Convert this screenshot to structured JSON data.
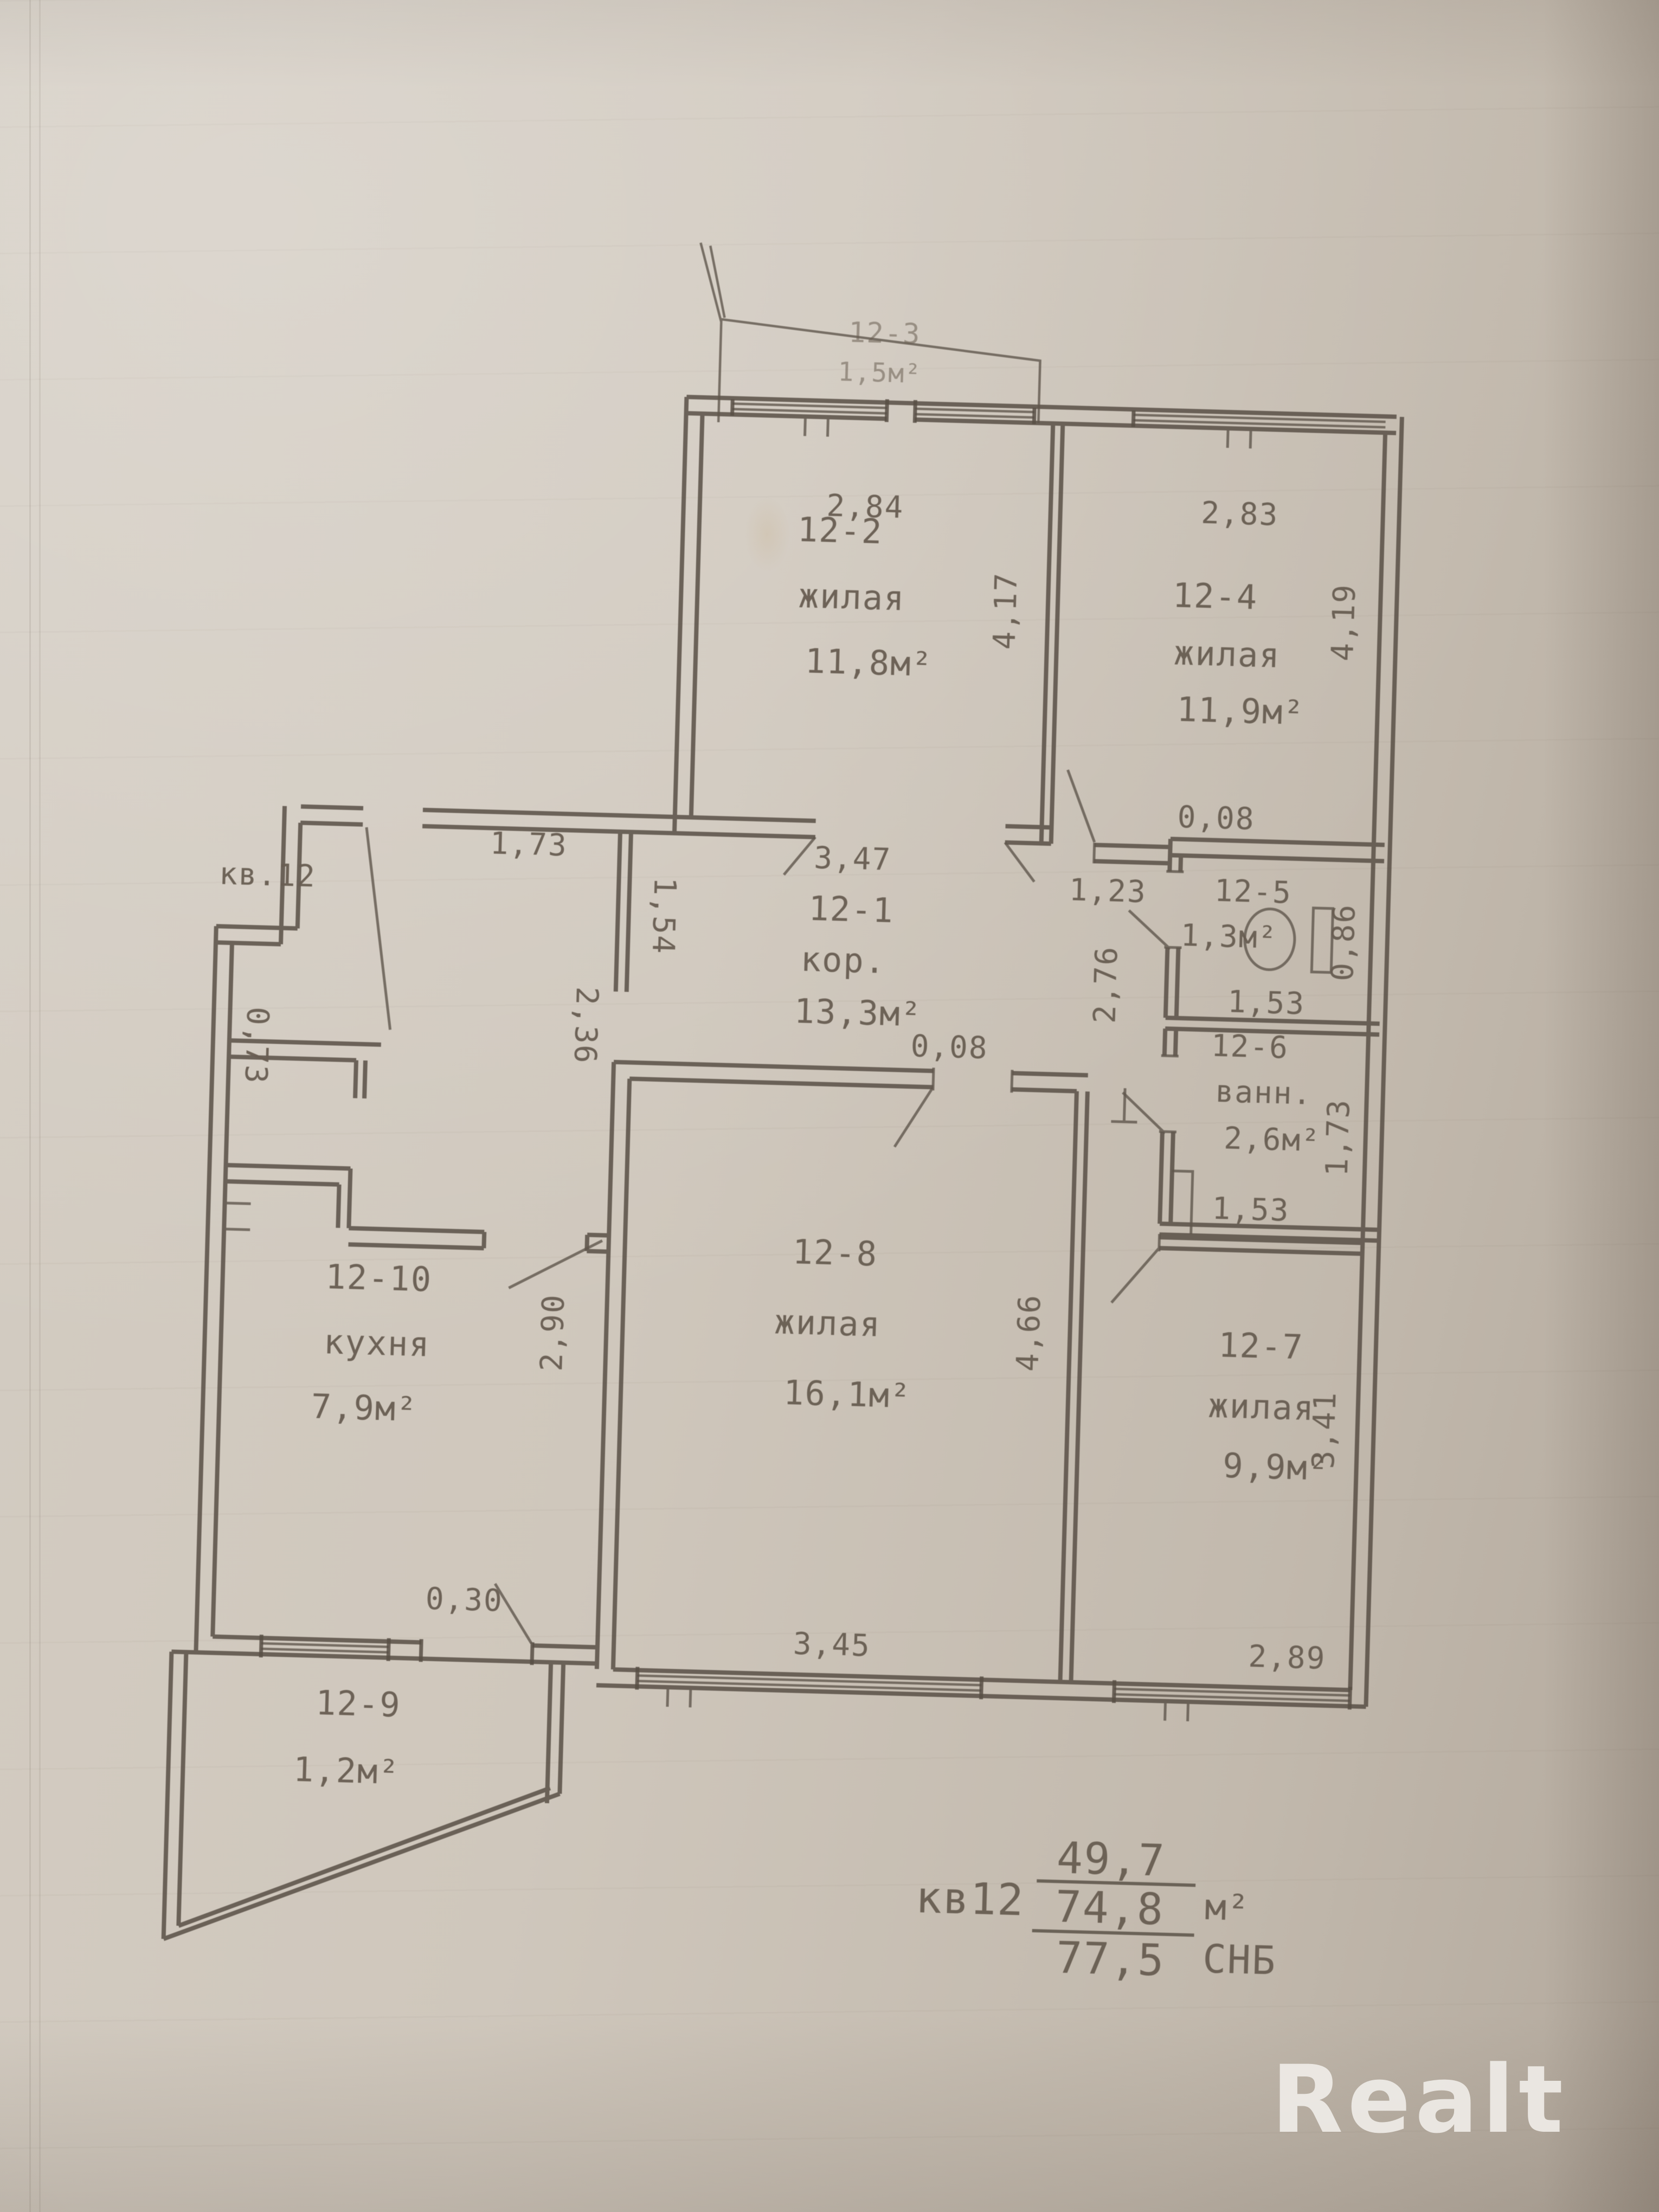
{
  "colors": {
    "paper": "#cdc5b9",
    "ink_lines": "#584f45",
    "ink_text": "#675d51",
    "watermark": "#efece7"
  },
  "apartment_note": "кв.12",
  "rooms": {
    "r12_1": {
      "id": "12-1",
      "name": "кор.",
      "area": "13,3м²"
    },
    "r12_2": {
      "id": "12-2",
      "name": "жилая",
      "area": "11,8м²"
    },
    "r12_3": {
      "id": "12-3",
      "area": "1,5м²"
    },
    "r12_4": {
      "id": "12-4",
      "name": "жилая",
      "area": "11,9м²"
    },
    "r12_5": {
      "id": "12-5",
      "area": "1,3м²"
    },
    "r12_6": {
      "id": "12-6",
      "name": "ванн.",
      "area": "2,6м²"
    },
    "r12_7": {
      "id": "12-7",
      "name": "жилая",
      "area": "9,9м²"
    },
    "r12_8": {
      "id": "12-8",
      "name": "жилая",
      "area": "16,1м²"
    },
    "r12_9": {
      "id": "12-9",
      "area": "1,2м²"
    },
    "r12_10": {
      "id": "12-10",
      "name": "кухня",
      "area": "7,9м²"
    }
  },
  "dims": {
    "d284": "2,84",
    "d283": "2,83",
    "d417": "4,17",
    "d419": "4,19",
    "d173_top": "1,73",
    "d347": "3,47",
    "d123": "1,23",
    "d008_wc": "0,08",
    "d154": "1,54",
    "d236": "2,36",
    "d153_wc": "1,53",
    "d086": "0,86",
    "d276": "2,76",
    "d153_bath": "1,53",
    "d173_bath": "1,73",
    "d073": "0,73",
    "d290": "2,90",
    "d466": "4,66",
    "d008_room8": "0,08",
    "d345": "3,45",
    "d341": "3,41",
    "d289": "2,89",
    "d030": "0,30"
  },
  "summary": {
    "label": "кв12",
    "living_area": "49,7",
    "total_area": "74,8",
    "total_units": "м²",
    "snb_value": "77,5",
    "snb_units": "СНБ"
  },
  "watermark": {
    "text": "Realt"
  }
}
